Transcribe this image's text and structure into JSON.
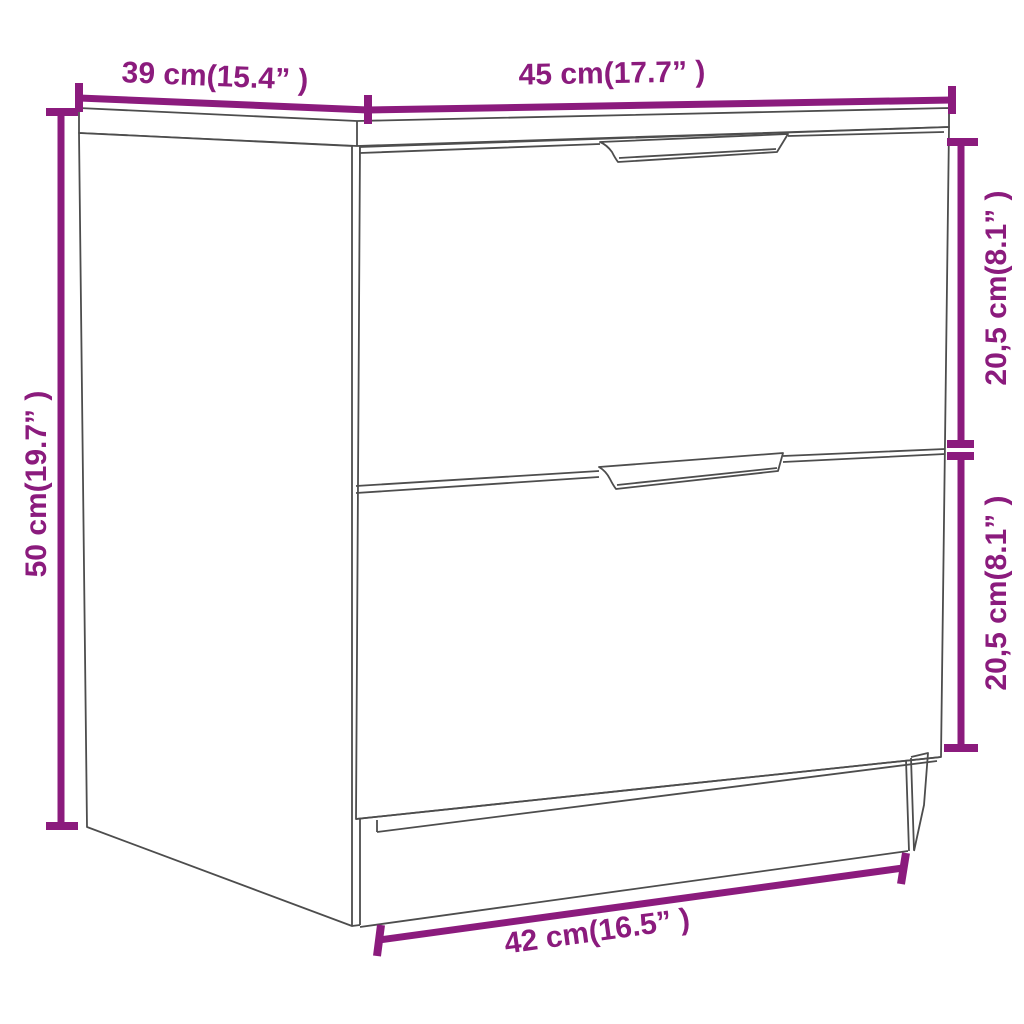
{
  "image": {
    "kind": "product-dimension-diagram",
    "subject": "bedside-cabinet-with-two-drawers",
    "background_color": "#ffffff",
    "line_color": "#4d4d4d",
    "accent_color": "#8B1B7D"
  },
  "dimensions": {
    "depth": {
      "label": "39 cm(15.4” )",
      "cm": "39",
      "inches": "15.4"
    },
    "width": {
      "label": "45 cm(17.7” )",
      "cm": "45",
      "inches": "17.7"
    },
    "height": {
      "label": "50 cm(19.7” )",
      "cm": "50",
      "inches": "19.7"
    },
    "top_drawer": {
      "label": "20,5 cm(8.1” )",
      "cm": "20,5",
      "inches": "8.1"
    },
    "bottom_drawer": {
      "label": "20,5 cm(8.1” )",
      "cm": "20,5",
      "inches": "8.1"
    },
    "base_width": {
      "label": "42 cm(16.5” )",
      "cm": "42",
      "inches": "16.5"
    }
  }
}
